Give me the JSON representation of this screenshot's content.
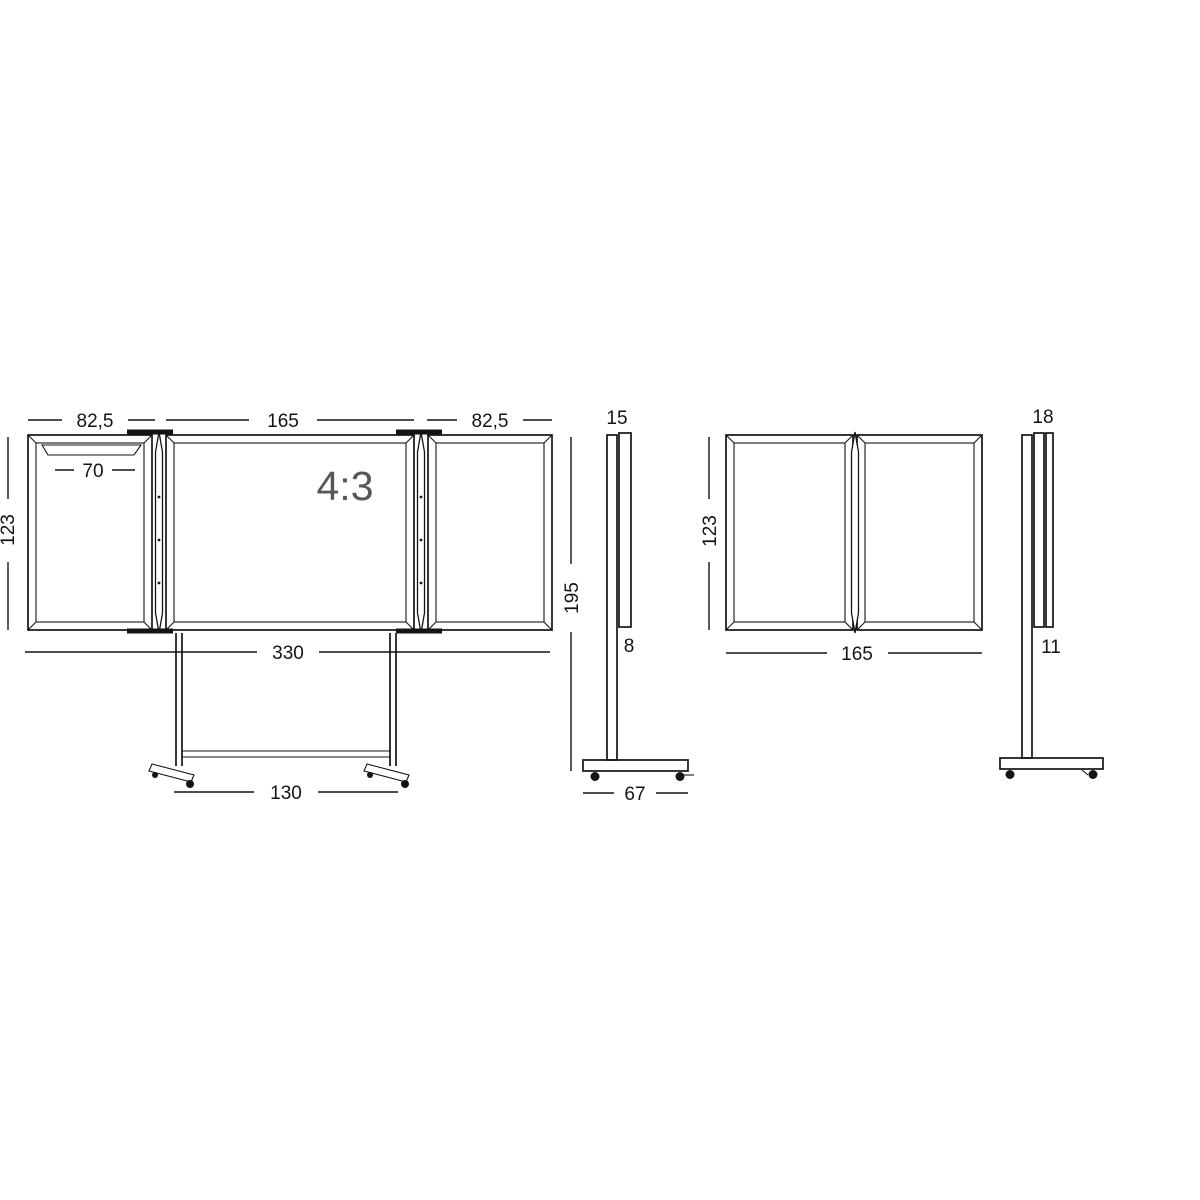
{
  "drawing_title": "mobile folding whiteboard dimensional drawing",
  "colors": {
    "background": "#ffffff",
    "line": "#141414",
    "label": "#141414",
    "watermark": "#56575b"
  },
  "figures": {
    "front_open": {
      "name": "front view, wings opened, on mobile stand",
      "dims": {
        "wing_left": "82,5",
        "center": "165",
        "wing_right": "82,5",
        "tray": "70",
        "height": "123",
        "total_width": "330",
        "base_width": "130"
      },
      "watermark": "4:3"
    },
    "side_open": {
      "name": "side view, wings opened",
      "dims": {
        "depth_top": "15",
        "height": "195",
        "panel_depth": "8",
        "base_depth": "67"
      }
    },
    "front_closed": {
      "name": "front view, wings closed",
      "dims": {
        "height": "123",
        "width": "165"
      }
    },
    "side_closed": {
      "name": "side view, wings closed",
      "dims": {
        "depth_top": "18",
        "panel_depth": "11"
      }
    }
  }
}
